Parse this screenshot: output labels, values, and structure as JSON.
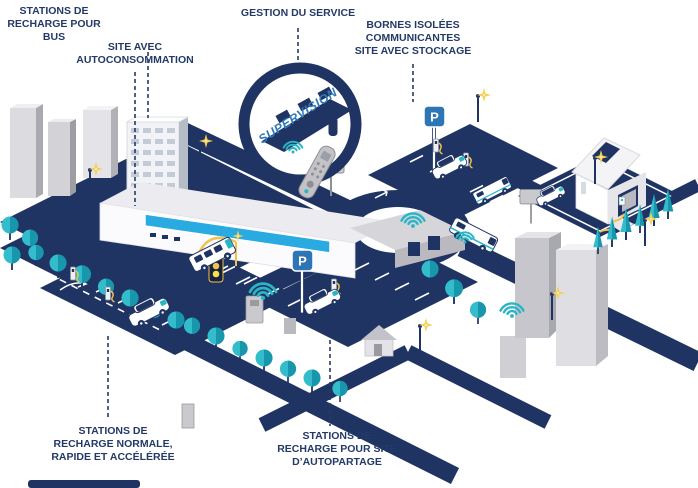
{
  "scene": {
    "labels": {
      "bus": "STATIONS DE\nRECHARGE POUR\nBUS",
      "autoconsumption": "SITE AVEC\nAUTOCONSOMMATION",
      "service": "GESTION DU SERVICE",
      "isolated": "BORNES ISOLÉES\nCOMMUNICANTES\nSITE AVEC STOCKAGE",
      "normal": "STATIONS DE\nRECHARGE NORMALE,\nRAPIDE ET ACCÉLÉRÉE",
      "carshare": "STATIONS DE\nRECHARGE POUR SITE\nD’AUTOPARTAGE",
      "supervision": "SUPERVISION"
    },
    "signs": {
      "parking_letter": "P"
    },
    "colors": {
      "navy": "#1f3463",
      "teal": "#2ab5c7",
      "teal_dark": "#1796ac",
      "yellow": "#f2c14e",
      "parking_blue": "#2e75b6",
      "glass_blue": "#29abe2",
      "supervision_blue": "#2d7bb9",
      "label_text": "#243a66",
      "gray_light": "#e2e2e6",
      "gray_mid": "#bfbfc6",
      "gray_dark": "#9a9aa1"
    }
  }
}
